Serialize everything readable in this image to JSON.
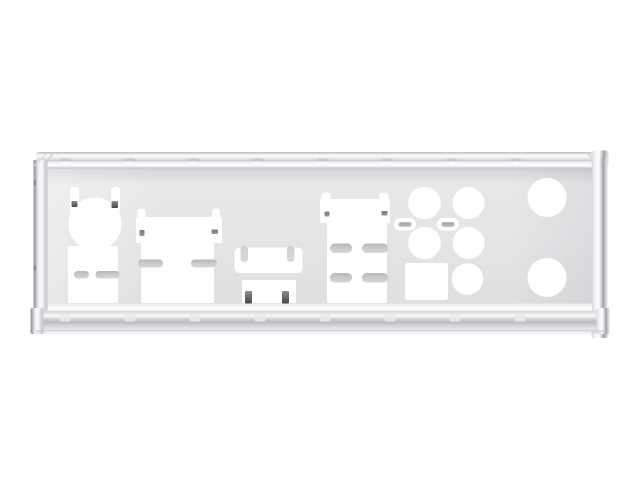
{
  "meta": {
    "subject": "metal-io-shield-backplate-product-photo",
    "background": "#ffffff"
  },
  "palette": {
    "cutout": "#ffffff",
    "face": "#e4e5e7",
    "face_shadow_band": "#c6c8cb",
    "edge_dark_line": "#9b9ea2",
    "edge_highlight": "#ffffff",
    "tongue_gray": "#c8cacd",
    "clip_dark": "#44474b"
  },
  "plate": {
    "top_dimples_x": [
      65,
      130,
      194,
      258,
      323,
      387,
      452,
      516
    ],
    "bottom_ticks_x": [
      65,
      130,
      195,
      260,
      325,
      390,
      455,
      520
    ],
    "left_edge_dot_y": [
      180,
      265
    ]
  },
  "cutouts": [
    {
      "name": "ps2-combo-port-cutout",
      "shapes": [
        {
          "t": "rect",
          "x": 70,
          "y": 187,
          "w": 9,
          "h": 26,
          "rx": 3,
          "fill": "cutout",
          "name": "ps2-clip-slot-left"
        },
        {
          "t": "rect",
          "x": 111,
          "y": 187,
          "w": 9,
          "h": 26,
          "rx": 3,
          "fill": "cutout",
          "name": "ps2-clip-slot-right"
        },
        {
          "t": "circle",
          "cx": 95,
          "cy": 224,
          "r": 26.5,
          "fill": "cutout",
          "name": "ps2-round-hole"
        },
        {
          "t": "rect",
          "x": 71.5,
          "y": 201,
          "w": 6,
          "h": 6,
          "rx": 1,
          "fill": "grad:clip",
          "name": "ps2-metal-clip-left"
        },
        {
          "t": "rect",
          "x": 111.5,
          "y": 201,
          "w": 6.5,
          "h": 7,
          "rx": 1,
          "fill": "grad:clip",
          "name": "ps2-metal-clip-right"
        }
      ]
    },
    {
      "name": "usb-pair-cutout",
      "shapes": [
        {
          "t": "rect",
          "x": 68,
          "y": 246,
          "w": 50,
          "h": 57,
          "rx": 1.5,
          "fill": "cutout",
          "name": "usb-pair-hole"
        },
        {
          "t": "rect",
          "x": 74,
          "y": 271,
          "w": 15,
          "h": 7.5,
          "rx": 3.5,
          "fill": "grad:tongue",
          "name": "ground-tongue"
        },
        {
          "t": "rect",
          "x": 95.5,
          "y": 271,
          "w": 24,
          "h": 7.5,
          "rx": 3.5,
          "fill": "grad:tongue",
          "name": "ground-tongue"
        }
      ]
    },
    {
      "name": "dvi-port-cutout",
      "shapes": [
        {
          "t": "rect",
          "x": 137.5,
          "y": 208.5,
          "w": 8,
          "h": 14,
          "rx": 3,
          "fill": "cutout",
          "name": "clip-slot-left"
        },
        {
          "t": "rect",
          "x": 212,
          "y": 208.5,
          "w": 8,
          "h": 14,
          "rx": 3,
          "fill": "cutout",
          "name": "clip-slot-right"
        },
        {
          "t": "rect",
          "x": 136,
          "y": 217,
          "w": 86,
          "h": 26,
          "rx": 1.5,
          "fill": "cutout",
          "name": "dvi-upper-hole"
        },
        {
          "t": "rect",
          "x": 141,
          "y": 242,
          "w": 73,
          "h": 61,
          "rx": 1.5,
          "fill": "cutout",
          "name": "dvi-lower-hole"
        },
        {
          "t": "rect",
          "x": 139.5,
          "y": 230,
          "w": 5,
          "h": 6,
          "rx": 1,
          "fill": "grad:speck",
          "name": "metal-clip-mark"
        },
        {
          "t": "rect",
          "x": 211.5,
          "y": 229.5,
          "w": 6.5,
          "h": 4.5,
          "rx": 1,
          "fill": "grad:speck",
          "name": "metal-clip-mark"
        },
        {
          "t": "rect",
          "x": 138,
          "y": 259.5,
          "w": 25,
          "h": 8,
          "rx": 4,
          "fill": "grad:tongue",
          "name": "ground-tongue"
        },
        {
          "t": "rect",
          "x": 191,
          "y": 259.5,
          "w": 26,
          "h": 8,
          "rx": 4,
          "fill": "grad:tongue",
          "name": "ground-tongue"
        }
      ]
    },
    {
      "name": "hdmi-port-cutout",
      "shapes": [
        {
          "t": "rect",
          "x": 234.5,
          "y": 247.5,
          "w": 68,
          "h": 25.5,
          "rx": 5,
          "fill": "cutout",
          "name": "hdmi-hole"
        },
        {
          "t": "rect",
          "x": 240.5,
          "y": 246,
          "w": 7.5,
          "h": 16,
          "rx": 3.5,
          "fill": "grad:hook",
          "name": "hdmi-top-hook-left"
        },
        {
          "t": "rect",
          "x": 287,
          "y": 246,
          "w": 7.5,
          "h": 16,
          "rx": 3.5,
          "fill": "grad:hook",
          "name": "hdmi-top-hook-right"
        }
      ]
    },
    {
      "name": "displayport-cutout",
      "shapes": [
        {
          "t": "rect",
          "x": 242,
          "y": 280,
          "w": 54,
          "h": 23,
          "rx": 2,
          "fill": "cutout",
          "name": "displayport-hole"
        },
        {
          "t": "rect",
          "x": 245,
          "y": 291,
          "w": 7,
          "h": 12.5,
          "rx": 1,
          "fill": "grad:clip",
          "name": "metal-clip-left"
        },
        {
          "t": "rect",
          "x": 282,
          "y": 291,
          "w": 7,
          "h": 12.5,
          "rx": 1,
          "fill": "grad:clip",
          "name": "metal-clip-right"
        }
      ]
    },
    {
      "name": "lan-usb-stack-cutout",
      "shapes": [
        {
          "t": "rect",
          "x": 321.5,
          "y": 192.5,
          "w": 9,
          "h": 12,
          "rx": 3,
          "fill": "cutout",
          "name": "clip-slot-left"
        },
        {
          "t": "rect",
          "x": 379.5,
          "y": 192.5,
          "w": 9,
          "h": 12,
          "rx": 3,
          "fill": "cutout",
          "name": "clip-slot-right"
        },
        {
          "t": "rect",
          "x": 320,
          "y": 199,
          "w": 70,
          "h": 24,
          "rx": 1.5,
          "fill": "cutout",
          "name": "lan-upper-hole"
        },
        {
          "t": "rect",
          "x": 327,
          "y": 222,
          "w": 60,
          "h": 81,
          "rx": 1.5,
          "fill": "cutout",
          "name": "usb-lower-hole"
        },
        {
          "t": "rect",
          "x": 324.5,
          "y": 211.5,
          "w": 5,
          "h": 5,
          "rx": 1,
          "fill": "grad:speck",
          "name": "metal-clip-mark"
        },
        {
          "t": "rect",
          "x": 381.5,
          "y": 211,
          "w": 6,
          "h": 4.5,
          "rx": 1,
          "fill": "grad:speck",
          "name": "metal-clip-mark"
        },
        {
          "t": "rect",
          "x": 330,
          "y": 243.5,
          "w": 22,
          "h": 9.5,
          "rx": 4.5,
          "fill": "grad:tongue",
          "name": "ground-tongue"
        },
        {
          "t": "rect",
          "x": 362,
          "y": 243.5,
          "w": 26,
          "h": 9.5,
          "rx": 4.5,
          "fill": "grad:tongue",
          "name": "ground-tongue"
        },
        {
          "t": "rect",
          "x": 330,
          "y": 273,
          "w": 22,
          "h": 9.5,
          "rx": 4.5,
          "fill": "grad:tongue",
          "name": "ground-tongue"
        },
        {
          "t": "rect",
          "x": 362,
          "y": 273,
          "w": 26,
          "h": 9.5,
          "rx": 4.5,
          "fill": "grad:tongue",
          "name": "ground-tongue"
        }
      ]
    },
    {
      "name": "audio-jack-cutouts",
      "shapes": [
        {
          "t": "circle",
          "cx": 424.5,
          "cy": 203,
          "r": 16.3,
          "fill": "cutout",
          "name": "audio-jack-hole"
        },
        {
          "t": "circle",
          "cx": 468.5,
          "cy": 203,
          "r": 16,
          "fill": "cutout",
          "name": "audio-jack-hole"
        },
        {
          "t": "circle",
          "cx": 424.5,
          "cy": 243,
          "r": 16.3,
          "fill": "cutout",
          "name": "audio-jack-hole"
        },
        {
          "t": "circle",
          "cx": 468.5,
          "cy": 243,
          "r": 16,
          "fill": "cutout",
          "name": "audio-jack-hole"
        },
        {
          "t": "circle",
          "cx": 467.5,
          "cy": 279,
          "r": 15.8,
          "fill": "cutout",
          "name": "audio-jack-hole"
        },
        {
          "t": "rect",
          "x": 394,
          "y": 218,
          "w": 22,
          "h": 12.5,
          "rx": 6,
          "fill": "cutout",
          "name": "latch-slot"
        },
        {
          "t": "rect",
          "x": 398.5,
          "y": 222.2,
          "w": 13,
          "h": 4.6,
          "rx": 2.3,
          "fill": "grad:tongue2",
          "name": "latch-tab"
        },
        {
          "t": "rect",
          "x": 437,
          "y": 218,
          "w": 22,
          "h": 12.5,
          "rx": 6,
          "fill": "cutout",
          "name": "latch-slot"
        },
        {
          "t": "rect",
          "x": 441.5,
          "y": 222.2,
          "w": 13,
          "h": 4.6,
          "rx": 2.3,
          "fill": "grad:tongue2",
          "name": "latch-tab"
        },
        {
          "t": "rect",
          "x": 405,
          "y": 263,
          "w": 43,
          "h": 37,
          "rx": 2.5,
          "fill": "cutout",
          "name": "optical-spdif-hole"
        }
      ]
    },
    {
      "name": "vent-hole-top",
      "shapes": [
        {
          "t": "circle",
          "cx": 547,
          "cy": 197.5,
          "r": 19.5,
          "fill": "cutout",
          "name": "round-vent-hole"
        }
      ]
    },
    {
      "name": "vent-hole-bottom",
      "shapes": [
        {
          "t": "circle",
          "cx": 547,
          "cy": 277.5,
          "r": 19.5,
          "fill": "cutout",
          "name": "round-vent-hole"
        }
      ]
    }
  ]
}
